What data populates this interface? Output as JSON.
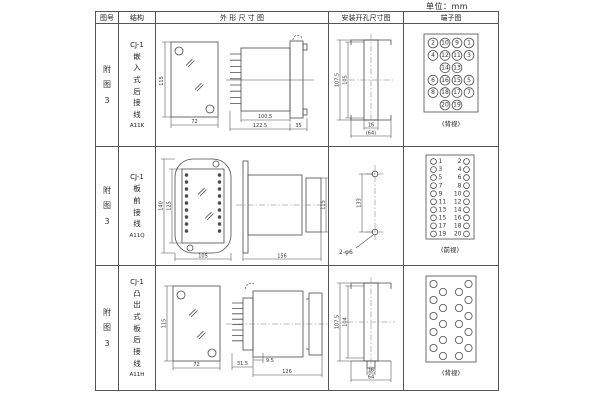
{
  "unit_label": "单位：mm",
  "headers": {
    "figure": "图号",
    "structure": "结构",
    "outline": "外 形 尺 寸 图",
    "cutout": "安装开孔尺寸图",
    "terminal": "端子图"
  },
  "rows": [
    {
      "figure": "附图3",
      "model": "CJ-1",
      "mount": "嵌入式后接线",
      "code": "A11K",
      "outline": {
        "h": "115",
        "w": "72",
        "d1": "100.5",
        "d2": "122.5",
        "d3": "35"
      },
      "cutout": {
        "h1": "107.5",
        "h2": "105",
        "w1": "16",
        "w2": "(64)"
      },
      "terminal": {
        "caption": "(背视)",
        "layout": "grid",
        "rows": [
          [
            "2",
            "10",
            "9",
            "1"
          ],
          [
            "4",
            "12",
            "11",
            "3"
          ],
          [
            "14",
            "13"
          ],
          [
            "6",
            "16",
            "15",
            "5"
          ],
          [
            "8",
            "18",
            "17",
            "7"
          ],
          [
            "20",
            "19"
          ]
        ]
      }
    },
    {
      "figure": "附图3",
      "model": "CJ-1",
      "mount": "板前接线",
      "code": "A11Q",
      "outline": {
        "h1": "140",
        "h2": "125",
        "w": "105",
        "d": "156",
        "h3": "115"
      },
      "cutout": {
        "pitch": "133",
        "holes": "2-φ6"
      },
      "terminal": {
        "caption": "(前视)",
        "layout": "columns",
        "left": [
          "1",
          "3",
          "5",
          "7",
          "9",
          "11",
          "13",
          "15",
          "17",
          "19"
        ],
        "right": [
          "2",
          "4",
          "6",
          "8",
          "10",
          "12",
          "14",
          "16",
          "18",
          "20"
        ]
      }
    },
    {
      "figure": "附图3",
      "model": "CJ-1",
      "mount": "凸出式板后接线",
      "code": "A11H",
      "outline": {
        "h": "115",
        "w": "72",
        "d1": "31.5",
        "d2": "9.5",
        "d3": "126"
      },
      "cutout": {
        "h1": "107.5",
        "h2": "104",
        "w1": "16",
        "w2": "64"
      },
      "terminal": {
        "caption": "(背视)",
        "layout": "staggered"
      }
    }
  ]
}
